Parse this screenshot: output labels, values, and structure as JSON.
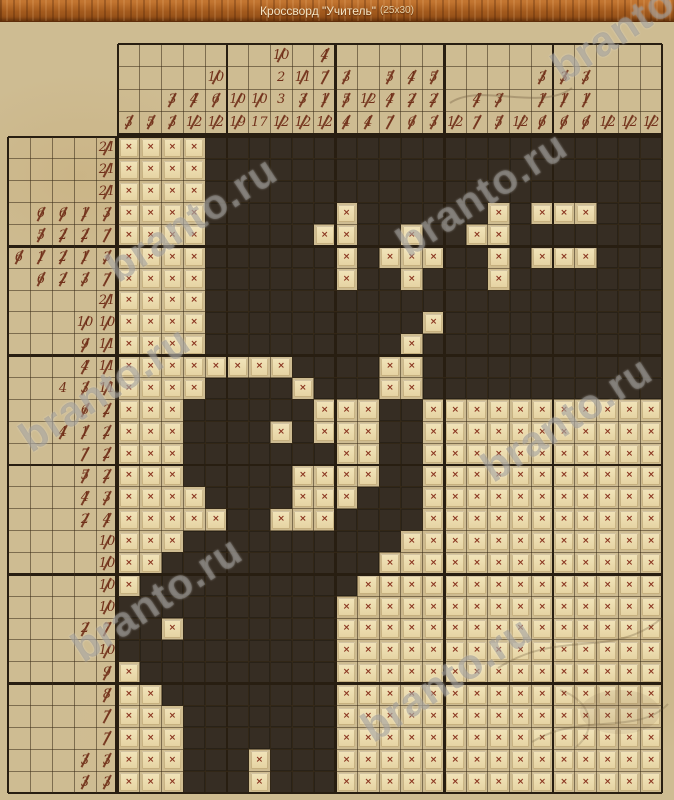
{
  "header": {
    "title": "Кроссворд \"Учитель\"",
    "size_label": "(25x30)"
  },
  "watermark_text": "branto.ru",
  "colors": {
    "header_wood": "#a35a1d",
    "parchment": "#cebc92",
    "filled_cell": "#362d23",
    "empty_tile": "#ecdcae",
    "clue_text": "#71301a",
    "x_mark": "#8a3520",
    "thin_line": "#5b4831",
    "thick_line": "#281e11",
    "watermark": "#8e8c88"
  },
  "puzzle": {
    "cols": 25,
    "rows": 30,
    "legend": {
      "filled": "#",
      "crossed": "."
    },
    "top_clues": [
      [
        3
      ],
      [
        5
      ],
      [
        3,
        3
      ],
      [
        4,
        12
      ],
      [
        10,
        6,
        12
      ],
      [
        10,
        19
      ],
      [
        10,
        17
      ],
      [
        10,
        2,
        3,
        12
      ],
      [
        11,
        3,
        12
      ],
      [
        4,
        7,
        1,
        12
      ],
      [
        3,
        5,
        4
      ],
      [
        12,
        4
      ],
      [
        5,
        4,
        7
      ],
      [
        4,
        2,
        6
      ],
      [
        5,
        2,
        3
      ],
      [
        12
      ],
      [
        4,
        7
      ],
      [
        3,
        5
      ],
      [
        12
      ],
      [
        3,
        1,
        6
      ],
      [
        3,
        1,
        6
      ],
      [
        3,
        1,
        6
      ],
      [
        12
      ],
      [
        12
      ],
      [
        12
      ]
    ],
    "top_clues_done": [
      [
        1
      ],
      [
        1
      ],
      [
        1,
        1
      ],
      [
        1,
        1
      ],
      [
        1,
        1,
        1
      ],
      [
        1,
        1
      ],
      [
        1,
        0
      ],
      [
        1,
        0,
        0,
        1
      ],
      [
        1,
        1,
        1
      ],
      [
        1,
        1,
        1,
        1
      ],
      [
        1,
        1,
        1
      ],
      [
        1,
        1
      ],
      [
        1,
        1,
        1
      ],
      [
        1,
        1,
        1
      ],
      [
        1,
        1,
        1
      ],
      [
        1
      ],
      [
        1,
        1
      ],
      [
        1,
        1
      ],
      [
        1
      ],
      [
        1,
        1,
        1
      ],
      [
        1,
        1,
        1
      ],
      [
        1,
        1,
        1
      ],
      [
        1
      ],
      [
        1
      ],
      [
        1
      ]
    ],
    "left_clues": [
      [
        21
      ],
      [
        21
      ],
      [
        21
      ],
      [
        6,
        6,
        1,
        3
      ],
      [
        5,
        2,
        2,
        7
      ],
      [
        6,
        1,
        2,
        1,
        3
      ],
      [
        6,
        2,
        3,
        7
      ],
      [
        21
      ],
      [
        10,
        10
      ],
      [
        9,
        11
      ],
      [
        4,
        11
      ],
      [
        4,
        3,
        11
      ],
      [
        6,
        2
      ],
      [
        4,
        1,
        2
      ],
      [
        7,
        2
      ],
      [
        5,
        2
      ],
      [
        4,
        3
      ],
      [
        2,
        4
      ],
      [
        10
      ],
      [
        10
      ],
      [
        10
      ],
      [
        10
      ],
      [
        2,
        7
      ],
      [
        10
      ],
      [
        9
      ],
      [
        8
      ],
      [
        7
      ],
      [
        7
      ],
      [
        3,
        3
      ],
      [
        3,
        3
      ]
    ],
    "left_clues_done": [
      [
        1
      ],
      [
        1
      ],
      [
        1
      ],
      [
        1,
        1,
        1,
        1
      ],
      [
        1,
        1,
        1,
        1
      ],
      [
        1,
        1,
        1,
        1,
        1
      ],
      [
        1,
        1,
        1,
        1
      ],
      [
        1
      ],
      [
        1,
        1
      ],
      [
        1,
        1
      ],
      [
        1,
        1
      ],
      [
        0,
        1,
        1
      ],
      [
        1,
        1
      ],
      [
        1,
        1,
        1
      ],
      [
        1,
        1
      ],
      [
        1,
        1
      ],
      [
        1,
        1
      ],
      [
        1,
        1
      ],
      [
        1
      ],
      [
        1
      ],
      [
        1
      ],
      [
        1
      ],
      [
        1,
        1
      ],
      [
        1
      ],
      [
        1
      ],
      [
        1
      ],
      [
        1
      ],
      [
        1
      ],
      [
        1,
        1
      ],
      [
        1,
        1
      ]
    ],
    "grid_rows": [
      "....#####################",
      "....#####################",
      "....#####################",
      "....######.######.#...###",
      "....#####..##.##..#######",
      "....######.#...##.#...###",
      "....######.##.###.#######",
      "....#####################",
      "....##########.##########",
      "....#########.###########",
      "........####..###########",
      "....####.###..###########",
      "...######...##...........",
      "...####.#...##...........",
      "...#######..##...........",
      "...#####....##...........",
      "....####...###...........",
      ".....##...####...........",
      "...##########............",
      "..##########.............",
      ".##########..............",
      "##########...............",
      "##.#######...............",
      "##########...............",
      ".#########...............",
      "..########...............",
      "...#######...............",
      "...#######...............",
      "...###.###...............",
      "...###.###..............."
    ]
  }
}
